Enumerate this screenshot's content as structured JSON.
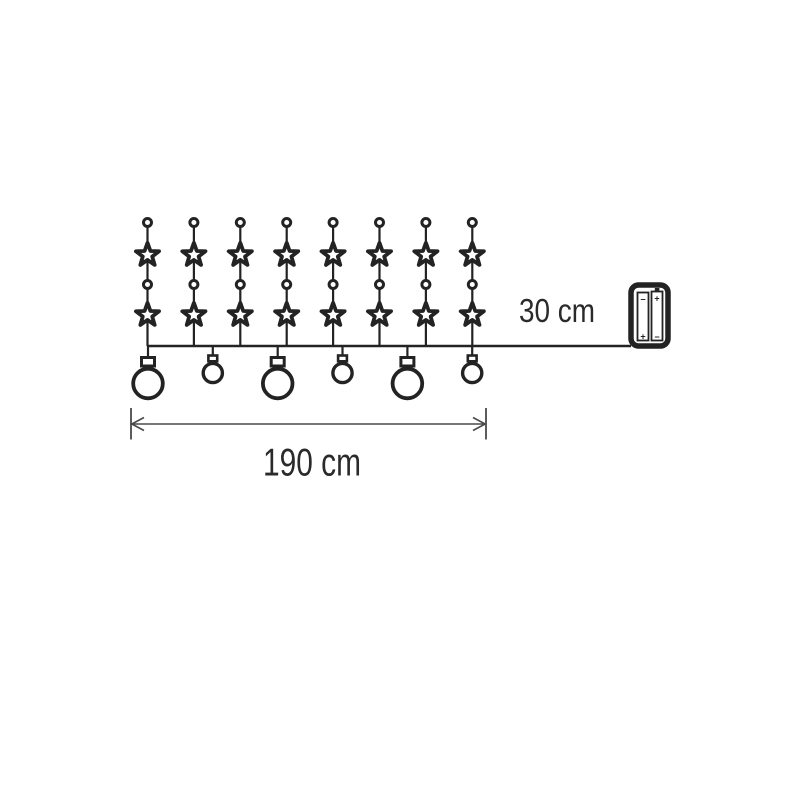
{
  "diagram": {
    "description": "Dimension diagram of a star-and-ball string light curtain with battery box",
    "background_color": "#ffffff",
    "ink_color": "#232323",
    "dimension_color": "#4a4a4a",
    "labels": {
      "lead_length": "30 cm",
      "total_length": "190 cm"
    },
    "strands": {
      "count": 8,
      "stars_per_strand": 2,
      "connector_dots_per_strand": 2
    },
    "balls": {
      "count": 6,
      "sizes": [
        "large",
        "small",
        "large",
        "small",
        "large",
        "small"
      ]
    },
    "battery_box": {
      "cell_count": 2,
      "cells": [
        {
          "top_mark": "−",
          "bottom_mark": "+"
        },
        {
          "top_mark": "+",
          "bottom_mark": "−"
        }
      ]
    }
  }
}
